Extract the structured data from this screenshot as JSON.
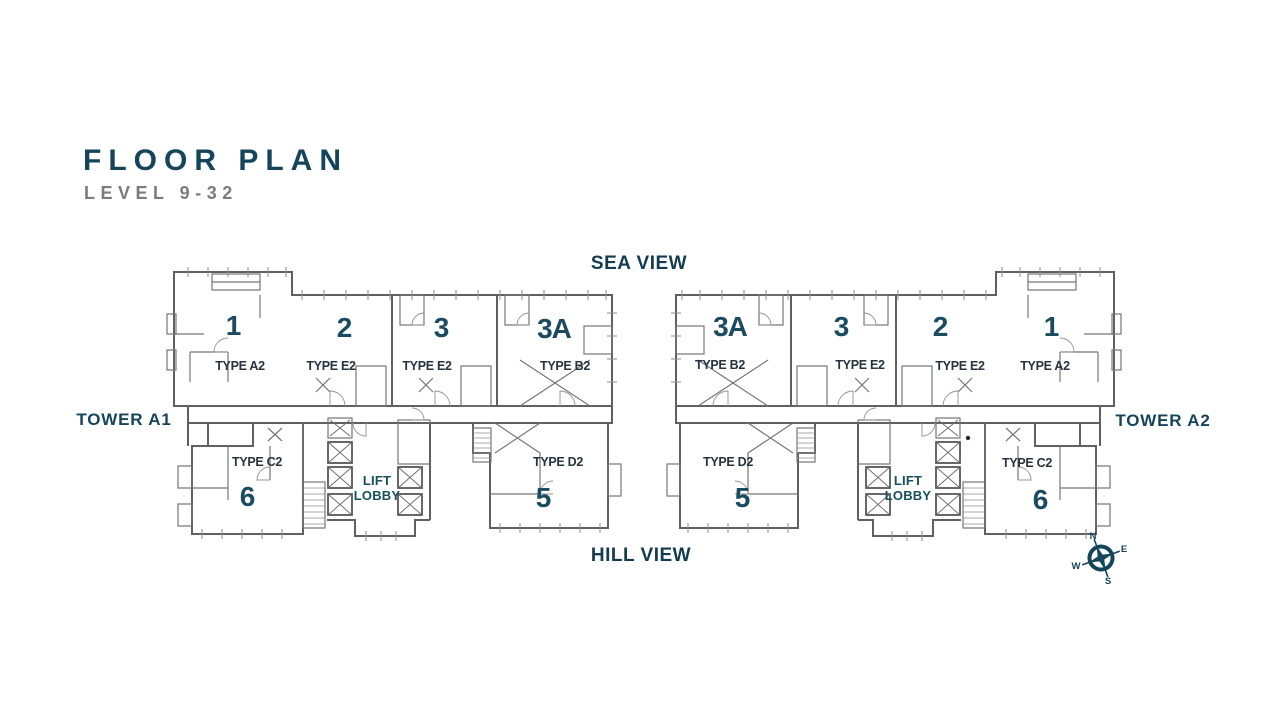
{
  "title": {
    "heading": "FLOOR PLAN",
    "subheading": "LEVEL 9-32"
  },
  "views": {
    "sea": "SEA VIEW",
    "hill": "HILL VIEW"
  },
  "towers": [
    {
      "label": "TOWER A1",
      "core_label": "LIFT\nLOBBY",
      "units": [
        {
          "number": "1",
          "type": "TYPE A2"
        },
        {
          "number": "2",
          "type": "TYPE E2"
        },
        {
          "number": "3",
          "type": "TYPE E2"
        },
        {
          "number": "3A",
          "type": "TYPE B2"
        },
        {
          "number": "6",
          "type": "TYPE C2"
        },
        {
          "number": "5",
          "type": "TYPE D2"
        }
      ]
    },
    {
      "label": "TOWER A2",
      "core_label": "LIFT\nLOBBY",
      "units": [
        {
          "number": "3A",
          "type": "TYPE B2"
        },
        {
          "number": "3",
          "type": "TYPE E2"
        },
        {
          "number": "2",
          "type": "TYPE E2"
        },
        {
          "number": "1",
          "type": "TYPE A2"
        },
        {
          "number": "5",
          "type": "TYPE D2"
        },
        {
          "number": "6",
          "type": "TYPE C2"
        }
      ]
    }
  ],
  "compass": {
    "north": "N",
    "east": "E",
    "south": "S",
    "west": "W"
  },
  "colors": {
    "accent_teal": "#15455B",
    "unit_number": "#1B4B60",
    "type_text": "#26343F",
    "subtitle_gray": "#7C7C7C",
    "wall_gray": "#606060",
    "background": "#FFFFFF"
  }
}
